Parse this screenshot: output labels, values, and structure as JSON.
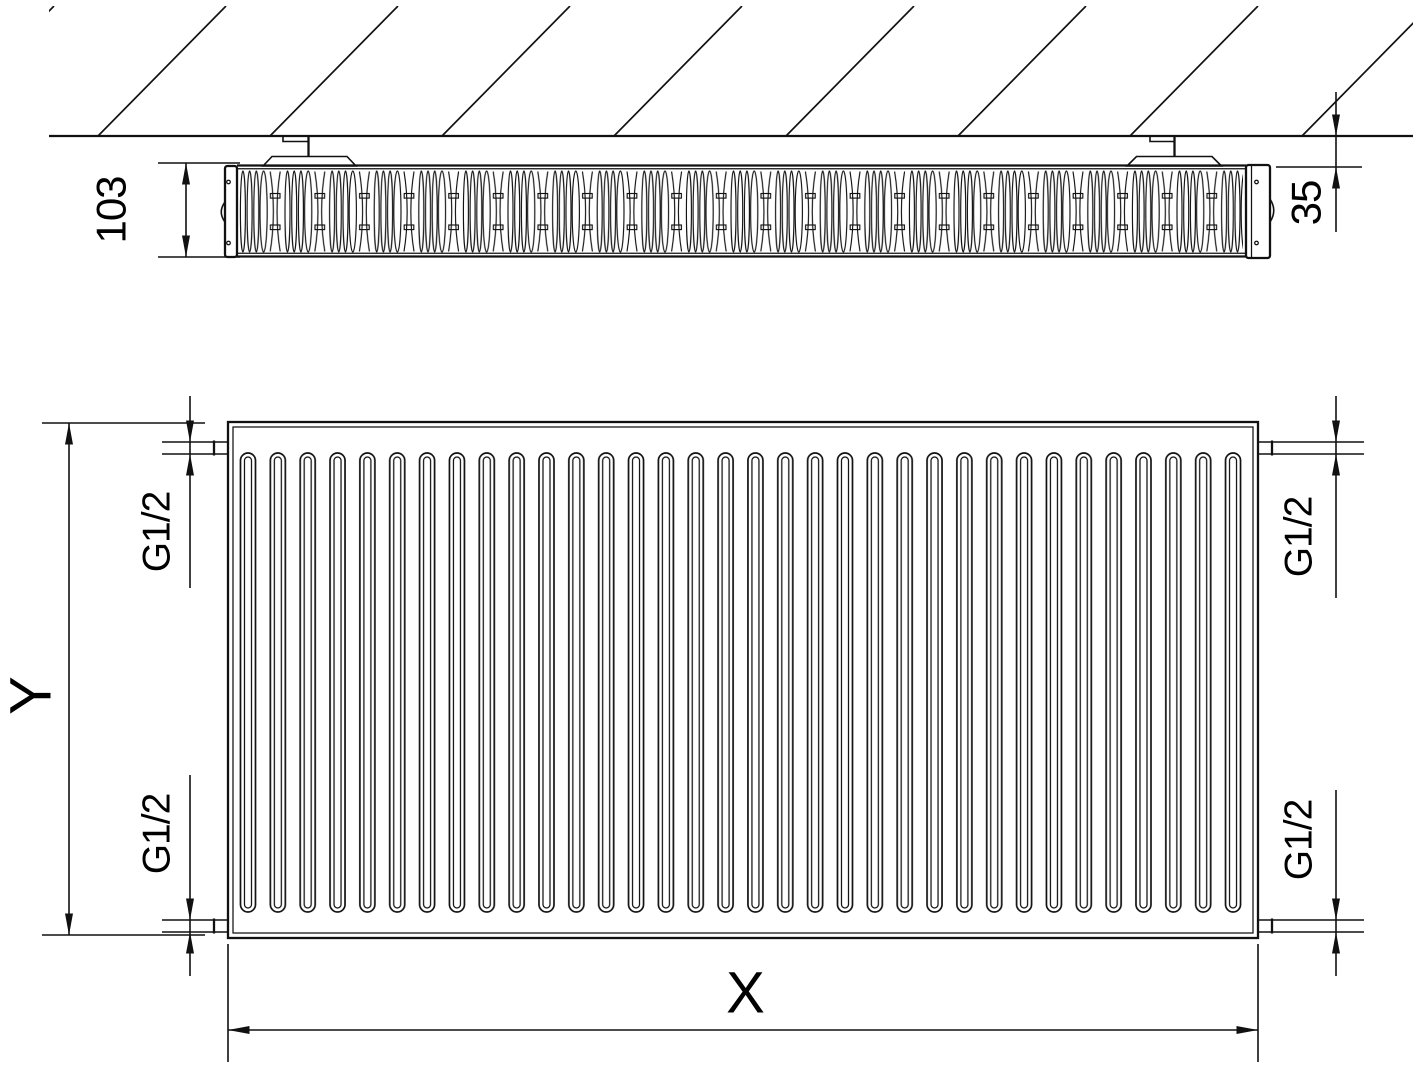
{
  "diagram": {
    "type": "technical-drawing",
    "subject": "panel radiator, top section view at wall and front view with dimensions",
    "colors": {
      "line": "#111111",
      "background": "#ffffff"
    },
    "labels": {
      "depth": "103",
      "wall_distance": "35",
      "height": "Y",
      "width": "X",
      "conn_top_left": "G1/2",
      "conn_bottom_left": "G1/2",
      "conn_top_right": "G1/2",
      "conn_bottom_right": "G1/2"
    }
  }
}
